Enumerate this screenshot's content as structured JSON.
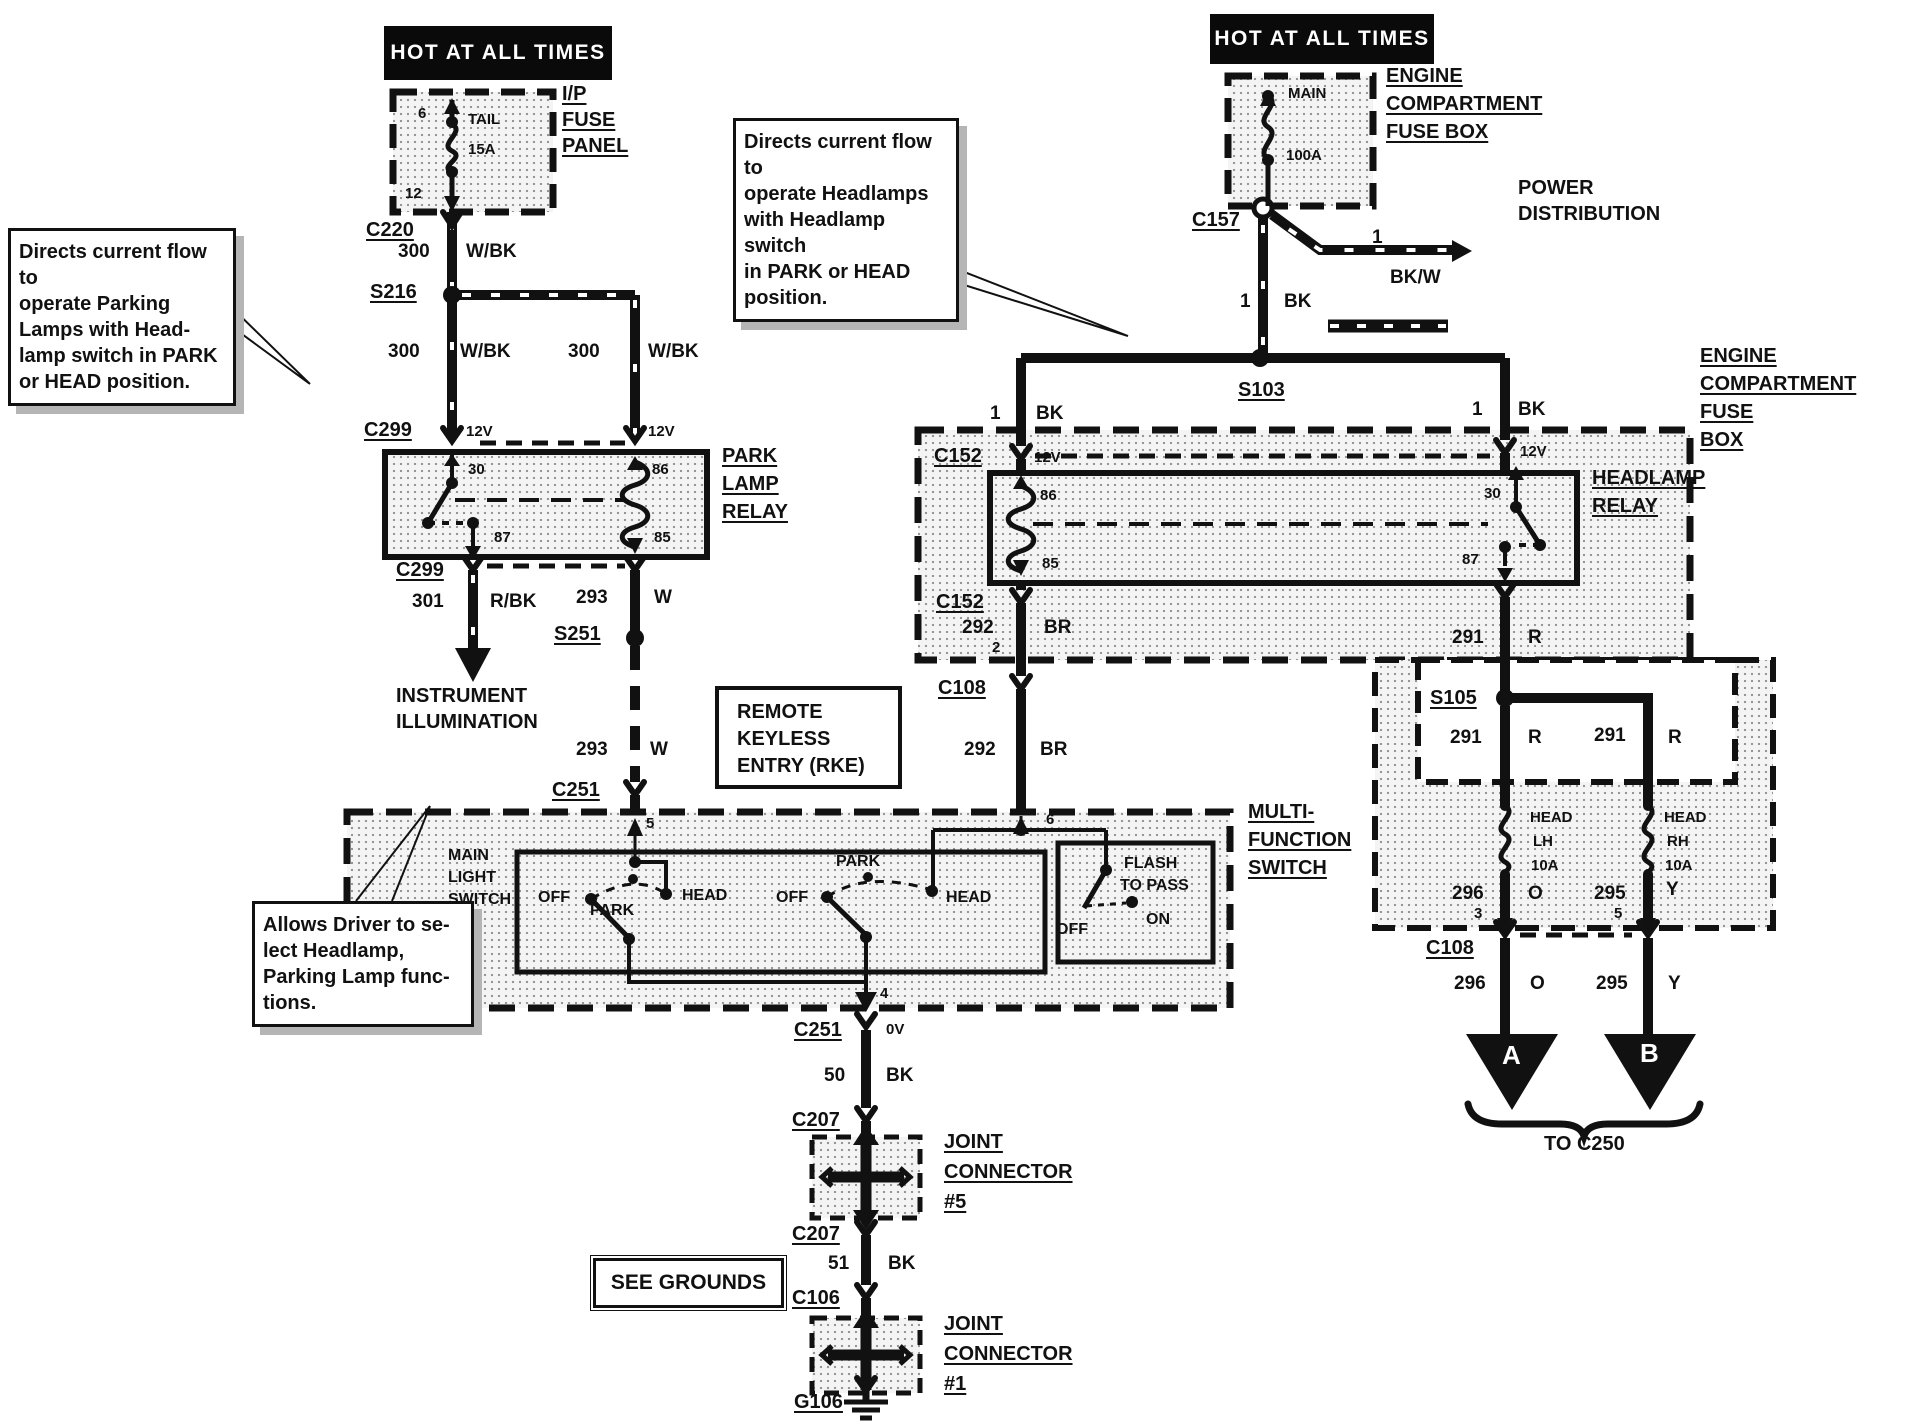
{
  "banners": {
    "left": "HOT AT ALL TIMES",
    "right": "HOT AT ALL TIMES"
  },
  "callouts": {
    "park": [
      "Directs current flow to",
      "operate Parking",
      "Lamps with Head-",
      "lamp switch in PARK",
      "or HEAD position."
    ],
    "head": [
      "Directs current flow to",
      "operate Headlamps",
      "with Headlamp switch",
      "in PARK or HEAD",
      "position."
    ],
    "driver": [
      "Allows Driver to se-",
      "lect Headlamp,",
      "Parking Lamp func-",
      "tions."
    ]
  },
  "ip_fuse_panel": {
    "label": [
      "I/P",
      "FUSE",
      "PANEL"
    ],
    "pin_in": "6",
    "pin_out": "12",
    "fuse": "TAIL",
    "rating": "15A"
  },
  "ecfb_top": {
    "label": [
      "ENGINE",
      "COMPARTMENT",
      "FUSE BOX"
    ],
    "fuse": "MAIN",
    "rating": "100A"
  },
  "ecfb_right": {
    "label": [
      "ENGINE",
      "COMPARTMENT",
      "FUSE",
      "BOX"
    ]
  },
  "park_relay": {
    "label": [
      "PARK",
      "LAMP",
      "RELAY"
    ],
    "pins": {
      "p30": "30",
      "p87": "87",
      "p86": "86",
      "p85": "85"
    }
  },
  "head_relay": {
    "label": [
      "HEADLAMP",
      "RELAY"
    ],
    "pins": {
      "p30": "30",
      "p87": "87",
      "p86": "86",
      "p85": "85"
    }
  },
  "rke": {
    "label": [
      "REMOTE",
      "KEYLESS",
      "ENTRY (RKE)"
    ]
  },
  "mfs": {
    "label": [
      "MULTI-",
      "FUNCTION",
      "SWITCH"
    ],
    "main_light_switch": [
      "MAIN",
      "LIGHT",
      "SWITCH"
    ],
    "sw1": {
      "off": "OFF",
      "park": "PARK",
      "head": "HEAD"
    },
    "sw2": {
      "off": "OFF",
      "park": "PARK",
      "head": "HEAD"
    },
    "flash": {
      "l1": "FLASH",
      "l2": "TO PASS",
      "off": "OFF",
      "on": "ON"
    },
    "pin5": "5",
    "pin6": "6",
    "pin4": "4"
  },
  "joint5": {
    "label": [
      "JOINT",
      "CONNECTOR",
      "#5"
    ]
  },
  "joint1": {
    "label": [
      "JOINT",
      "CONNECTOR",
      "#1"
    ]
  },
  "see_grounds": "SEE GROUNDS",
  "power_distribution": [
    "POWER",
    "DISTRIBUTION"
  ],
  "instrument_illumination": [
    "INSTRUMENT",
    "ILLUMINATION"
  ],
  "to_c250": "TO C250",
  "arrows": {
    "a": "A",
    "b": "B"
  },
  "connectors": {
    "c220": "C220",
    "s216": "S216",
    "c299_top": "C299",
    "c299_bottom": "C299",
    "s251": "S251",
    "c251_top": "C251",
    "c251_bottom": "C251",
    "c207_top": "C207",
    "c207_bottom": "C207",
    "c106": "C106",
    "g106": "G106",
    "c157": "C157",
    "s103": "S103",
    "c152_left": "C152",
    "c152_lower": "C152",
    "c108_upper": "C108",
    "c108_lower": "C108",
    "s105": "S105"
  },
  "fuses": {
    "head_lh": [
      "HEAD",
      "LH",
      "10A"
    ],
    "head_rh": [
      "HEAD",
      "RH",
      "10A"
    ]
  },
  "wires": {
    "w300_1": {
      "num": "300",
      "color": "W/BK"
    },
    "w300_2": {
      "num": "300",
      "color": "W/BK"
    },
    "w300_3": {
      "num": "300",
      "color": "W/BK"
    },
    "w301": {
      "num": "301",
      "color": "R/BK"
    },
    "w293_1": {
      "num": "293",
      "color": "W"
    },
    "w293_2": {
      "num": "293",
      "color": "W"
    },
    "w50": {
      "num": "50",
      "color": "BK"
    },
    "w51": {
      "num": "51",
      "color": "BK"
    },
    "w1_pd": {
      "num": "1",
      "color": "BK/W"
    },
    "w1_main": {
      "num": "1",
      "color": "BK"
    },
    "w1_left": {
      "num": "1",
      "color": "BK"
    },
    "w1_right": {
      "num": "1",
      "color": "BK"
    },
    "w292_upper": {
      "num": "292",
      "pin": "2",
      "color": "BR"
    },
    "w292_lower": {
      "num": "292",
      "color": "BR"
    },
    "w291_top": {
      "num": "291",
      "color": "R"
    },
    "w291_left": {
      "num": "291",
      "color": "R"
    },
    "w291_right": {
      "num": "291",
      "color": "R"
    },
    "w296_upper": {
      "num": "296",
      "pin": "3",
      "color": "O"
    },
    "w295_upper": {
      "num": "295",
      "pin": "5",
      "color": "Y"
    },
    "w296_lower": {
      "num": "296",
      "color": "O"
    },
    "w295_lower": {
      "num": "295",
      "color": "Y"
    }
  },
  "volts": {
    "c299_left": "12V",
    "c299_right": "12V",
    "c152_left": "12V",
    "c152_right": "12V",
    "c251_out": "0V"
  },
  "colors": {
    "ink": "#111111",
    "paper": "#ffffff"
  }
}
